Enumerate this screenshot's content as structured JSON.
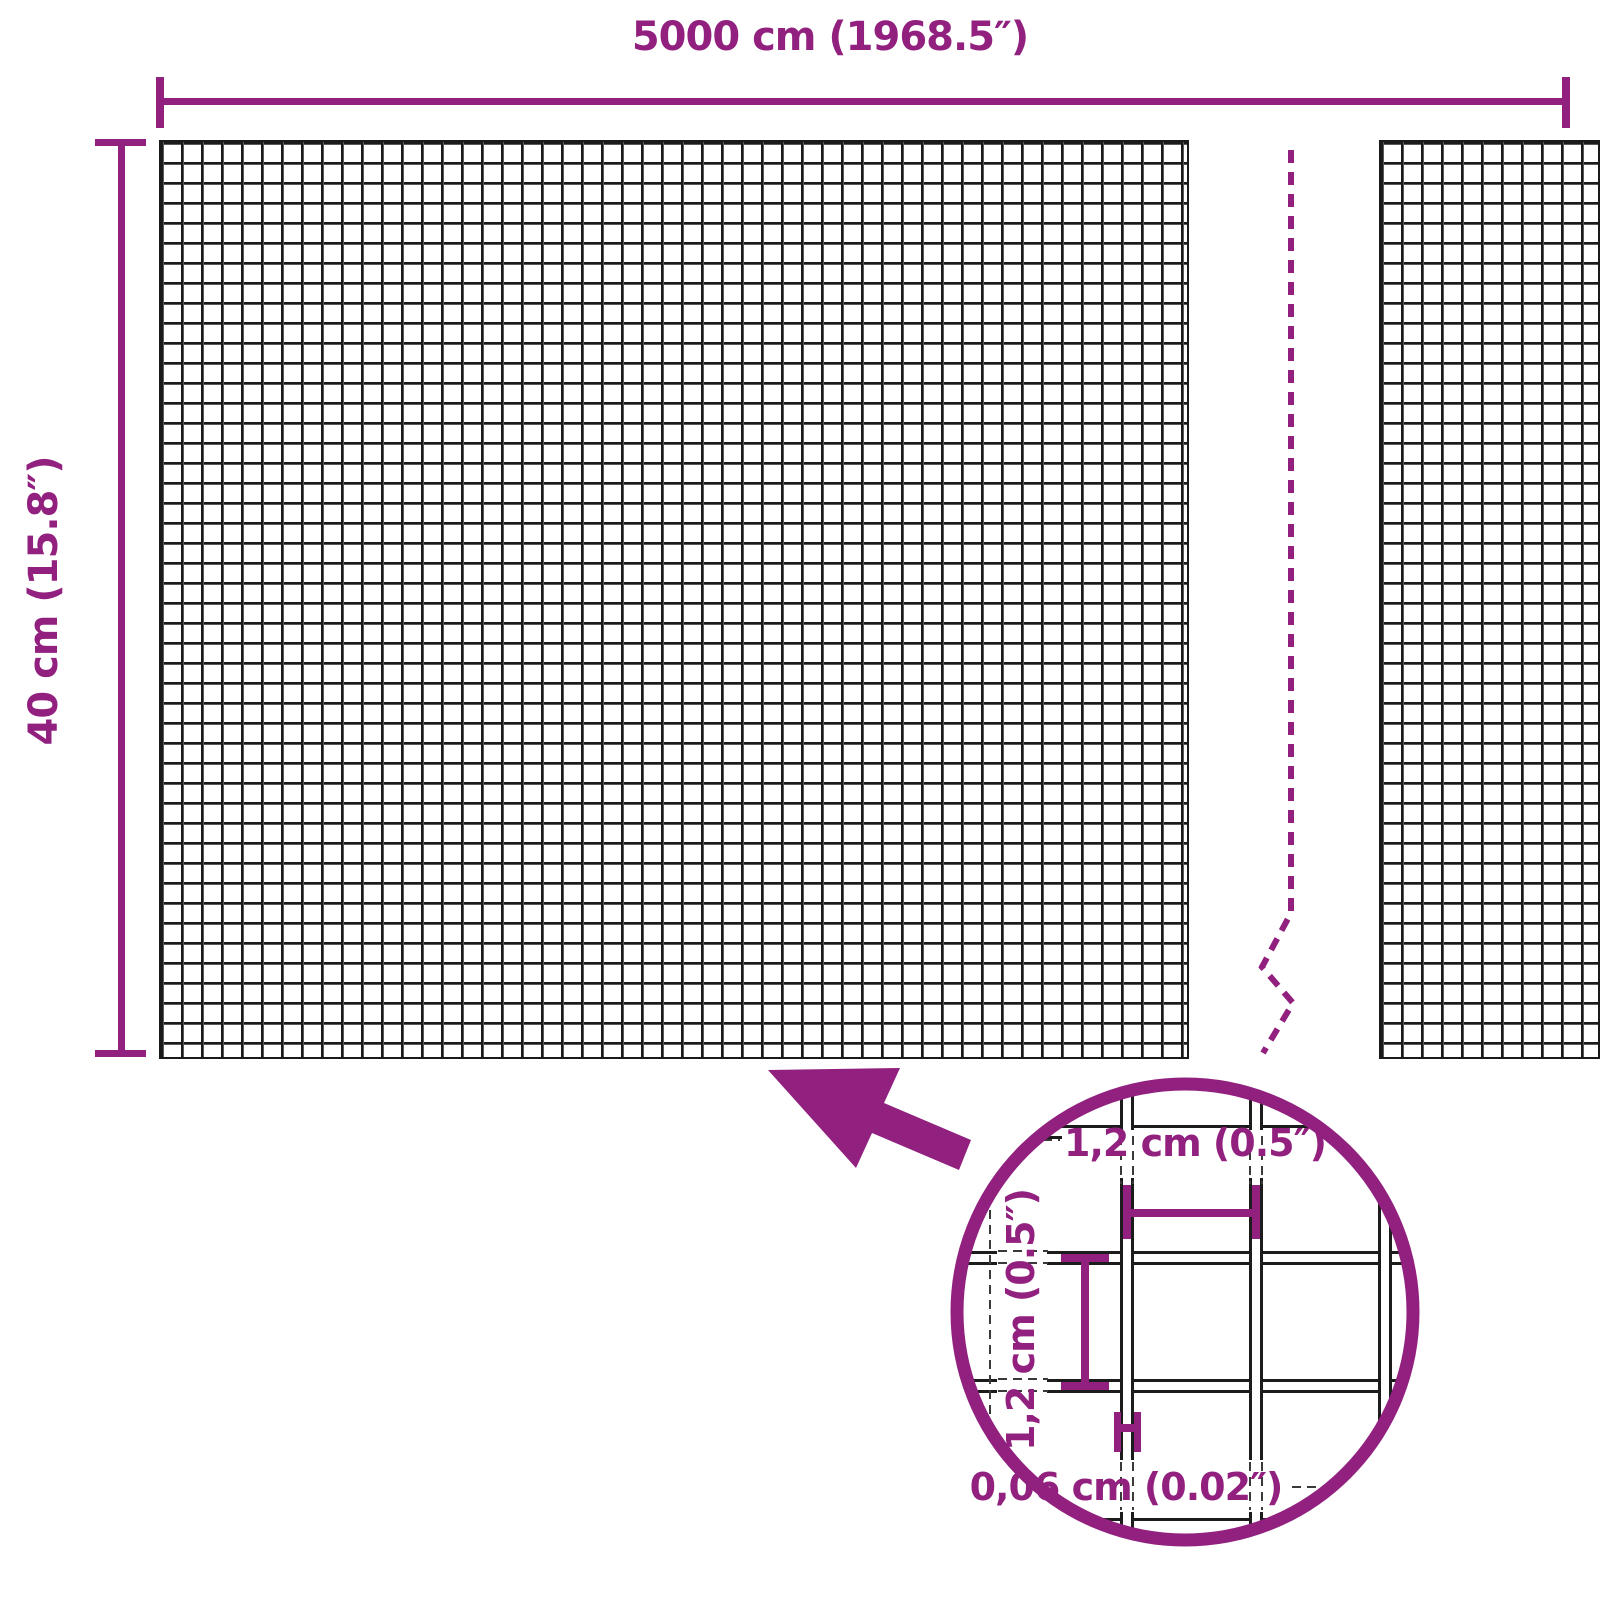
{
  "colors": {
    "accent": "#91207f",
    "mesh_line": "#1a1a1a",
    "background": "#ffffff"
  },
  "diagram": {
    "roll_width_label": "5000 cm (1968.5″)",
    "roll_height_label": "40 cm (15.8″)"
  },
  "detail_view": {
    "opening_width_label": "1,2 cm (0.5″)",
    "opening_height_label": "1,2 cm (0.5″)",
    "wire_thickness_label": "0,06 cm (0.02″)"
  }
}
